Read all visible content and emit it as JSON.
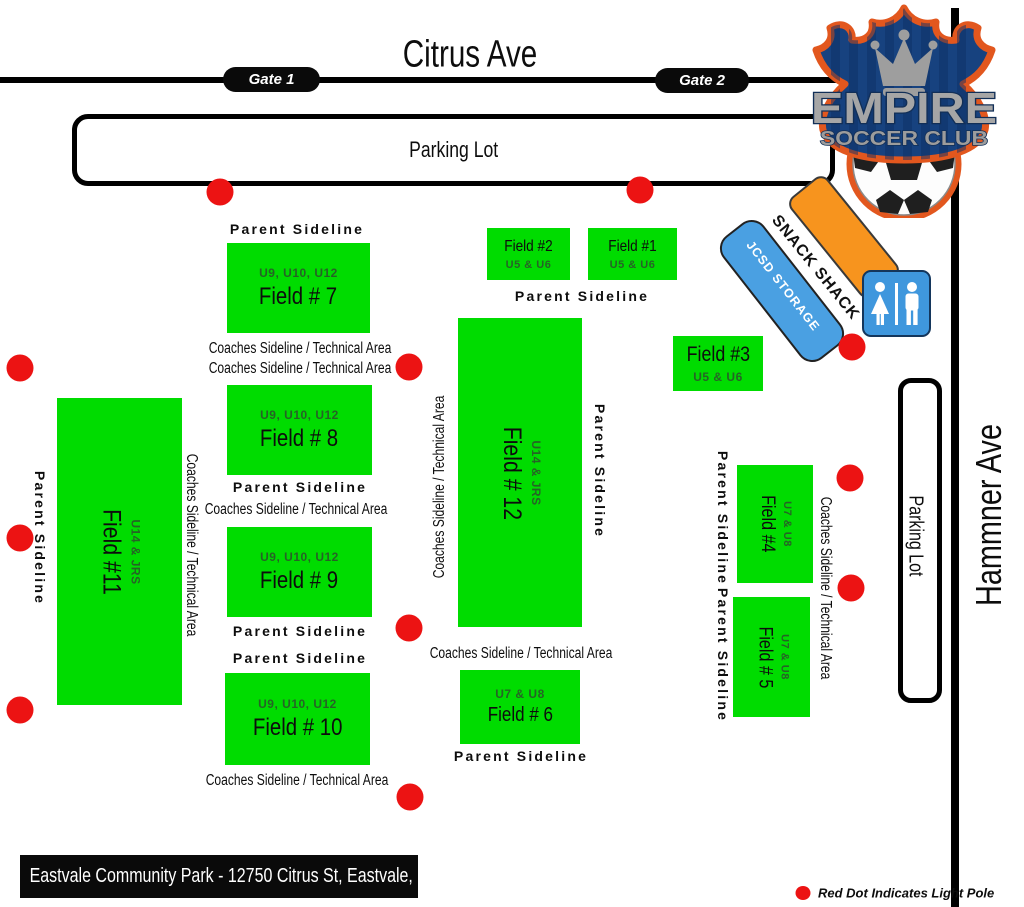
{
  "streets": {
    "top": "Citrus Ave",
    "right": "Hammner Ave"
  },
  "gates": [
    {
      "label": "Gate 1"
    },
    {
      "label": "Gate 2"
    }
  ],
  "parking_top": "Parking Lot",
  "parking_right": "Parking Lot",
  "sidelines": {
    "parent": "Parent Sideline",
    "coaches": "Coaches Sideline / Technical Area"
  },
  "fields": [
    {
      "name": "Field #1",
      "ages": "U5 & U6"
    },
    {
      "name": "Field #2",
      "ages": "U5 & U6"
    },
    {
      "name": "Field #3",
      "ages": "U5 & U6"
    },
    {
      "name": "Field #4",
      "ages": "U7 & U8"
    },
    {
      "name": "Field # 5",
      "ages": "U7 & U8"
    },
    {
      "name": "Field # 6",
      "ages": "U7 & U8"
    },
    {
      "name": "Field # 7",
      "ages": "U9, U10, U12"
    },
    {
      "name": "Field # 8",
      "ages": "U9, U10, U12"
    },
    {
      "name": "Field # 9",
      "ages": "U9, U10, U12"
    },
    {
      "name": "Field # 10",
      "ages": "U9, U10, U12"
    },
    {
      "name": "Field #11",
      "ages": "U14 & JRS"
    },
    {
      "name": "Field # 12",
      "ages": "U14 & JRS"
    }
  ],
  "buildings": {
    "snack_shack": "SNACK SHACK",
    "storage": "JCSD STORAGE"
  },
  "logo": {
    "line1": "EMPIRE",
    "line2": "SOCCER CLUB"
  },
  "footer_address": "Eastvale Community Park  - 12750 Citrus St, Eastvale, CA 92880",
  "legend_text": "Red Dot Indicates Light Pole",
  "colors": {
    "field_green": "#00dc00",
    "light_pole_red": "#ec1313",
    "storage_blue": "#4aa0e2",
    "snack_orange": "#f7941e",
    "restroom_blue": "#3f97dd",
    "logo_orange": "#e2571e",
    "logo_navy": "#17427f"
  }
}
